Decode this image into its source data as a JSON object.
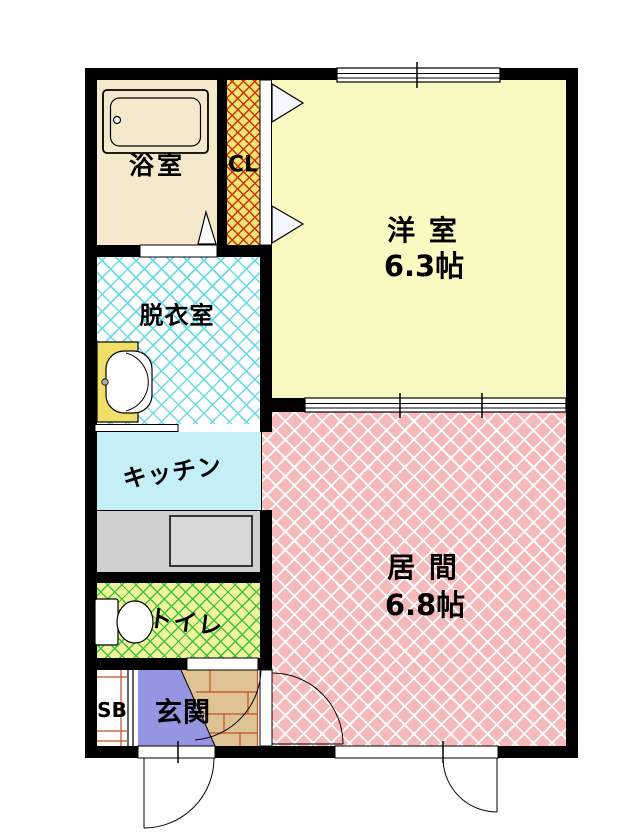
{
  "plan": {
    "type": "apartment-floor-plan",
    "rooms": {
      "bathroom": {
        "label": "浴室"
      },
      "closet": {
        "label": "CL"
      },
      "western_room": {
        "label": "洋 室",
        "size": "6.3帖"
      },
      "dressing_room": {
        "label": "脱衣室"
      },
      "kitchen": {
        "label": "キッチン"
      },
      "toilet": {
        "label": "トイレ"
      },
      "shoe_box": {
        "label": "SB"
      },
      "entrance": {
        "label": "玄関"
      },
      "living_room": {
        "label": "居 間",
        "size": "6.8帖"
      }
    },
    "colors": {
      "wall": "#000000",
      "bathroom_fill": "#f4e9cd",
      "closet_fill": "#ece66e",
      "closet_hatch": "#d22d10",
      "western_room_fill": "#fbf9c2",
      "dressing_hatch": "#6adce2",
      "kitchen_fill": "#c5eff6",
      "counter_fill": "#d0d0d0",
      "toilet_fill": "#eef39c",
      "toilet_hatch": "#3ec23e",
      "entrance_pit_fill": "#9595e2",
      "hall_step_fill": "#dfc394",
      "hall_step_lines": "#c05020",
      "living_fill": "#f5b9b9",
      "living_hatch": "#ffffff",
      "sink_cabinet_fill": "#f0e06a"
    },
    "fixtures": [
      "bathtub-icon",
      "washbasin-icon",
      "toilet-icon",
      "kitchen-counter-sink",
      "closet-bifold-doors",
      "entrance-door-swing",
      "living-room-door-swing",
      "toilet-door-swing",
      "hall-door-swing",
      "window-top",
      "sliding-partition"
    ]
  }
}
